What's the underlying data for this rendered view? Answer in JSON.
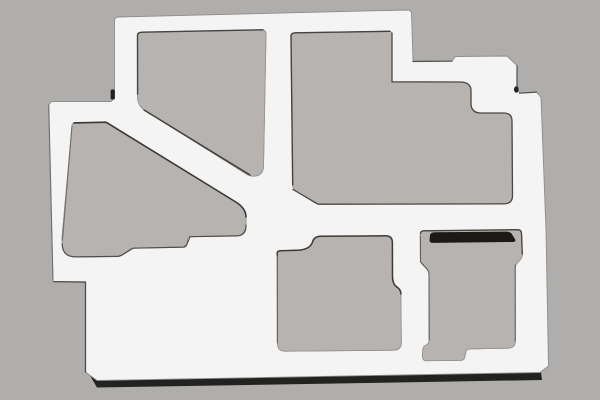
{
  "scene": {
    "description": "Photograph of a white laser-cut sheet metal plate (internal chassis bracket) with five irregular cutout openings, lying on a plain gray background with a dark shadow under its bottom edge",
    "object": "sheet-metal-plate",
    "canvas": {
      "width": 600,
      "height": 400
    }
  },
  "colors": {
    "background": "#b0aeac",
    "cutout_interior": "#b6b3b0",
    "plate": "#f4f4f5",
    "plate_edge": "#8e8d8b",
    "cutout_edge": "#95938f",
    "drop_shadow": "#161615",
    "slot_bar": "#1b1a19",
    "notch_dark": "#23221f"
  },
  "geometry": {
    "outer_outline": "M 114.5,21 Q 114.5,17.5 118,17 L 407,10 Q 411,10 411.5,13 L 413,61 L 452,61 L 455.5,56.5 L 507,56 L 517,65.5 L 517,88 L 519.5,93 L 536.5,92 L 541,97.5 L 546,230 L 548.5,366 L 540,372.5 L 97,380.5 L 85.5,372 L 85.5,282.5 L 53,281.5 L 48.5,105 L 51.5,101.5 L 111,101.5 L 114.5,98 Z",
    "cutouts": [
      {
        "name": "cutout-top-left-diagonal",
        "d": "M 137.5,37 Q 137.5,32.5 142,32.2 L 261,29.8 Q 266,29.7 266,34 L 263.5,166 Q 263.3,175.5 254,176.2 Q 250,176.4 245.5,173.5 L 144,110 Q 137.5,105 137.5,96 Z"
      },
      {
        "name": "cutout-top-right",
        "d": "M 291,37 Q 291,33 295,32.8 L 388,31.2 Q 392,31.1 392,35 L 392,81.8 L 461,82 Q 470.5,82.5 471,90 L 471,105 Q 472,112.5 480,113 L 504,113 Q 512,113.2 512,121 L 512.5,196 Q 512.5,203.8 503.5,203.9 L 321,204.2 Q 317,204.2 314,202.3 L 296,190.8 Q 292.8,188.8 292.7,185 Z"
      },
      {
        "name": "cutout-middle-left",
        "d": "M 72,126 Q 72,123 75,122.9 L 101,122.2 Q 106,122.1 110,124.6 L 233.5,200.5 Q 246,208 246,217 L 246,226.5 Q 246,235.7 236.5,235.9 L 190,236.7 Q 187.8,236.8 187.5,239 L 186.7,244.8 Q 186.4,247 184.2,247.1 L 133,248.2 Q 130.5,248.3 128.7,249.8 L 122.5,254.8 Q 120.6,256.4 118.2,256.4 L 76,256.9 Q 62.5,257 62.2,244 L 62,238 Z"
      },
      {
        "name": "cutout-bottom-middle",
        "d": "M 277.2,254 Q 277.2,251 280.5,250.8 L 297.5,250.2 Q 309.5,249.8 312.3,242.5 Q 314,236.4 320.5,236.3 L 385.5,235.8 Q 392.3,235.8 392.4,242.5 L 392.5,276.5 Q 392.5,284.5 397.5,287.5 Q 400.8,289.6 400.9,294 L 401.3,342.5 Q 401.4,350 393.5,350.2 L 285.5,351.2 Q 277.6,351.3 277.5,343.5 Z"
      },
      {
        "name": "cutout-bottom-right",
        "d": "M 420.3,234.5 Q 420.3,230.9 424,230.8 L 517.5,229.7 Q 521.4,229.7 521.5,233.5 L 522.3,254 Q 522.4,257.5 520,260 L 517.3,263 Q 515.2,265.2 515.2,268.5 L 515.3,341 Q 515.3,348 508,348.2 L 469.5,348.9 Q 466.5,349 465.9,351.8 L 464.6,357.5 Q 464,360.2 461.2,360.3 L 426.5,360.7 Q 422.3,360.7 422.5,356 L 422.8,349.5 Q 422.9,346.5 425.8,345.3 Q 429.2,344 429.2,340 L 429,274.5 Q 429,271 426.5,268.5 L 422.5,264.5 Q 420.4,262.4 420.4,259 Z"
      }
    ],
    "drop_shadow": "M 90,375.5 L 540.5,368.5 L 542,380 L 97,387.5 Z",
    "slot_bar": "M 435,232.8 L 506.5,232.2 Q 510,232.2 511.5,234.5 L 514.5,239.5 Q 515.5,241.3 513,241.4 L 432.5,242.3 Q 430,242.3 430.2,240 L 430.6,235.2 Q 430.8,232.9 435,232.8 Z",
    "corner_notch": {
      "x": 110.6,
      "y": 89.5,
      "width": 4.2,
      "height": 10,
      "rx": 1.5
    },
    "edge_notch": {
      "cx": 516.3,
      "cy": 89.5,
      "rx": 2.3,
      "ry": 3.2
    },
    "accents": [
      {
        "name": "edge-top-left-cutout-dark",
        "d": "M 137.6,94 L 137.5,35 Q 137.5,32.5 142,32.2 L 263,29.8",
        "color": "#45443f",
        "width": 1.4
      },
      {
        "name": "edge-top-left-cutout-diagonal",
        "d": "M 144,110 L 250,175",
        "color": "#403e3a",
        "width": 1.4
      },
      {
        "name": "edge-top-right-cutout-left-top",
        "d": "M 292.7,185 L 291,36 Q 291,33 295,32.8 L 390,31.3",
        "color": "#444340",
        "width": 1.4
      },
      {
        "name": "edge-top-right-cutout-steps",
        "d": "M 392,33 L 392,81.8 L 461,82 Q 470.5,82.5 471,90 L 471,105 Q 472,112.5 480,113 L 504,113 Q 512,113.2 512,121 L 512.5,196 Q 512.5,203.8 503.5,203.9 L 318,204.2 L 293,189.5",
        "color": "#4a4845",
        "width": 1.3
      },
      {
        "name": "edge-middle-left-cutout-diagonal",
        "d": "M 74,122.9 L 106,122.2 L 110,124.6 L 235,201.5 Q 246,208 246,217",
        "color": "#3a3834",
        "width": 1.6
      },
      {
        "name": "edge-middle-left-cutout-bottom",
        "d": "M 246,225 Q 246,235.7 236.5,235.9 L 190,236.7 L 186.7,244.8 L 184.2,247.1 L 133,248.2 L 122.5,254.8 L 118.2,256.4 L 76,256.9 Q 62.5,257 62.2,244",
        "color": "#504e4a",
        "width": 1.2
      },
      {
        "name": "edge-middle-left-cutout-left",
        "d": "M 62.5,240 L 72,126",
        "color": "#6e6c69",
        "width": 1
      },
      {
        "name": "edge-bottom-middle-cutout-top",
        "d": "M 277.3,256 L 277.2,253 Q 277.2,251 280.5,250.8 L 297.5,250.2 Q 309.5,249.8 312.3,242.5 Q 314,236.4 320.5,236.3 L 385.5,235.8 Q 392.3,235.8 392.4,242.5 L 392.5,276.5 Q 392.5,284.5 397.5,287.5 Q 400.8,289.6 400.9,294",
        "color": "#3d3b37",
        "width": 1.5
      },
      {
        "name": "edge-bottom-middle-cutout-left",
        "d": "M 277.3,343 L 277.3,255",
        "color": "#5c5a56",
        "width": 1
      },
      {
        "name": "edge-bottom-right-cutout-top",
        "d": "M 420.5,233.5 Q 420.5,230.9 424,230.8 L 517.5,229.7 Q 521.4,229.7 521.5,233.5 L 522.3,254",
        "color": "#46443f",
        "width": 1.3
      },
      {
        "name": "edge-bottom-right-cutout-left",
        "d": "M 429.2,340 L 429,274.5 Q 429,271 426.5,268.5 L 420.5,262 L 420.4,236",
        "color": "#5c5a56",
        "width": 1
      },
      {
        "name": "edge-bottom-right-cutout-right",
        "d": "M 515.2,265 L 515.3,341",
        "color": "#63615d",
        "width": 1
      },
      {
        "name": "edge-outer-step-top-right",
        "d": "M 413,61.5 L 452,61.2",
        "color": "#55534f",
        "width": 1.2
      },
      {
        "name": "edge-outer-jog-right",
        "d": "M 517,66 L 517,88 M 519.5,93.2 L 536.5,92.2",
        "color": "#504e4a",
        "width": 1.2
      },
      {
        "name": "edge-outer-left-step",
        "d": "M 85.5,372 L 85.5,282 L 54,281.6",
        "color": "#4c4a46",
        "width": 1.3
      },
      {
        "name": "edge-outer-arm-left",
        "d": "M 48.8,105 L 53,280",
        "color": "#6e6c69",
        "width": 1
      }
    ]
  }
}
